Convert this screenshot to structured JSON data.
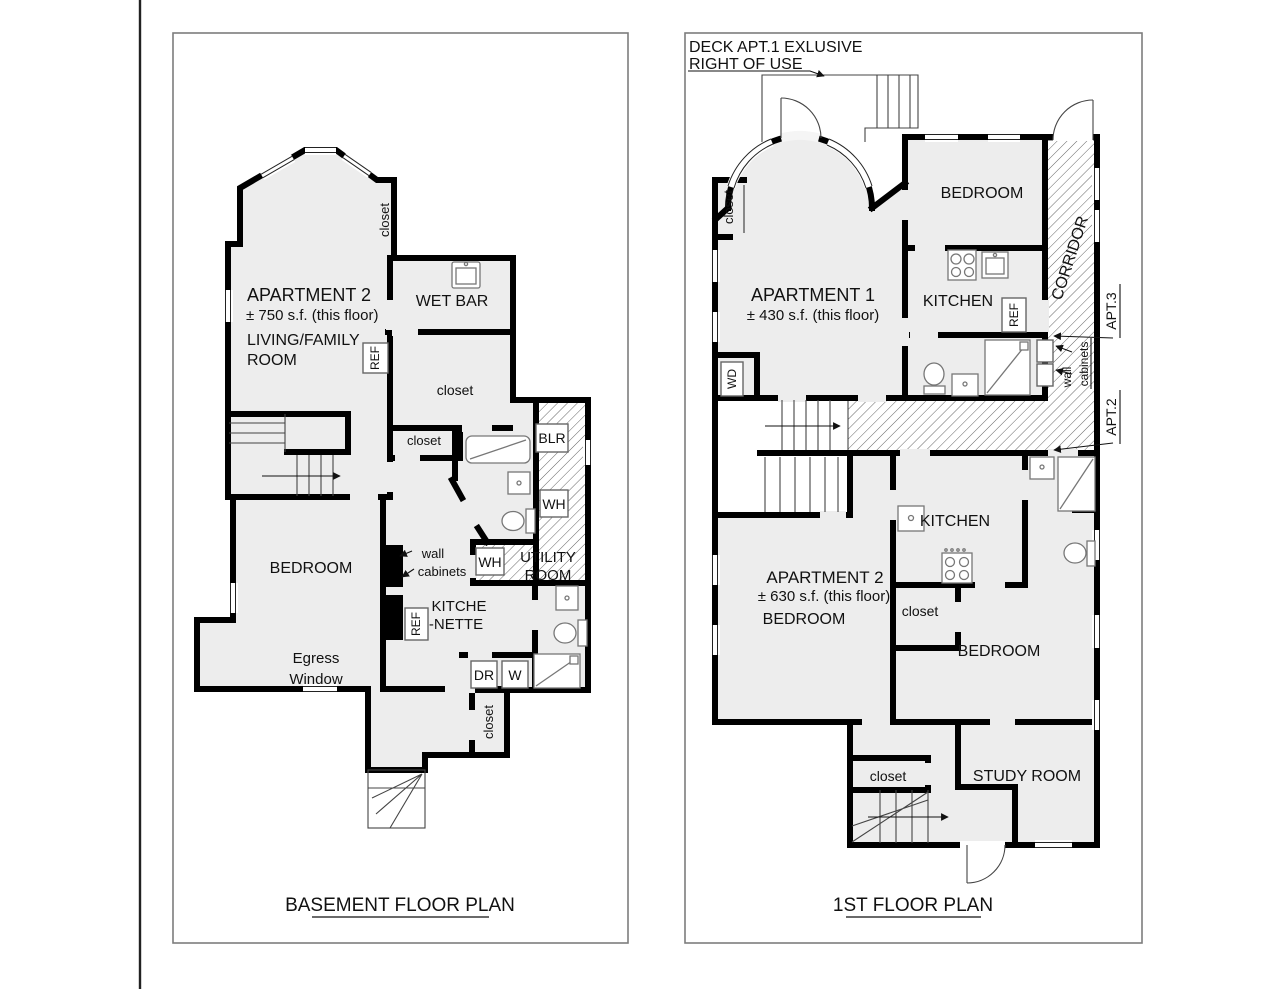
{
  "colors": {
    "wall": "#000000",
    "room_fill": "#ededed",
    "hatch_line": "#555555",
    "frame_border": "#7d7d7d",
    "fixture": "#777777"
  },
  "basement": {
    "title": "BASEMENT FLOOR PLAN",
    "labels": {
      "apartment": "APARTMENT 2",
      "area": "± 750 s.f. (this floor)",
      "living1": "LIVING/FAMILY",
      "living2": "ROOM",
      "wet_bar": "WET BAR",
      "closet_top": "closet",
      "ref_top": "REF",
      "closet_mid": "closet",
      "closet_small": "closet",
      "blr": "BLR",
      "wh_upper": "WH",
      "wh_lower": "WH",
      "utility1": "UTILITY",
      "utility2": "ROOM",
      "wall_cab1": "wall",
      "wall_cab2": "cabinets",
      "kitchenette1": "KITCHE",
      "kitchenette2": "-NETTE",
      "ref_bottom": "REF",
      "bedroom": "BEDROOM",
      "egress1": "Egress",
      "egress2": "Window",
      "dr": "DR",
      "w": "W",
      "closet_bottom": "closet"
    }
  },
  "first_floor": {
    "title": "1ST FLOOR PLAN",
    "labels": {
      "deck1": "DECK APT.1 EXLUSIVE",
      "deck2": "RIGHT OF USE",
      "closet_left": "closet",
      "apartment1": "APARTMENT 1",
      "area1": "± 430 s.f. (this floor)",
      "bedroom_apt1": "BEDROOM",
      "kitchen_apt1": "KITCHEN",
      "ref": "REF",
      "corridor": "CORRIDOR",
      "apt3": "APT.3",
      "apt2": "APT.2",
      "wall_cab1": "wall",
      "wall_cab2": "cabinets",
      "wd": "WD",
      "kitchen_apt2": "KITCHEN",
      "apartment2": "APARTMENT 2",
      "area2": "± 630 s.f. (this floor)",
      "bedroom_apt2_left": "BEDROOM",
      "closet_apt2": "closet",
      "bedroom_apt2_right": "BEDROOM",
      "closet_bottom": "closet",
      "study": "STUDY ROOM"
    }
  }
}
